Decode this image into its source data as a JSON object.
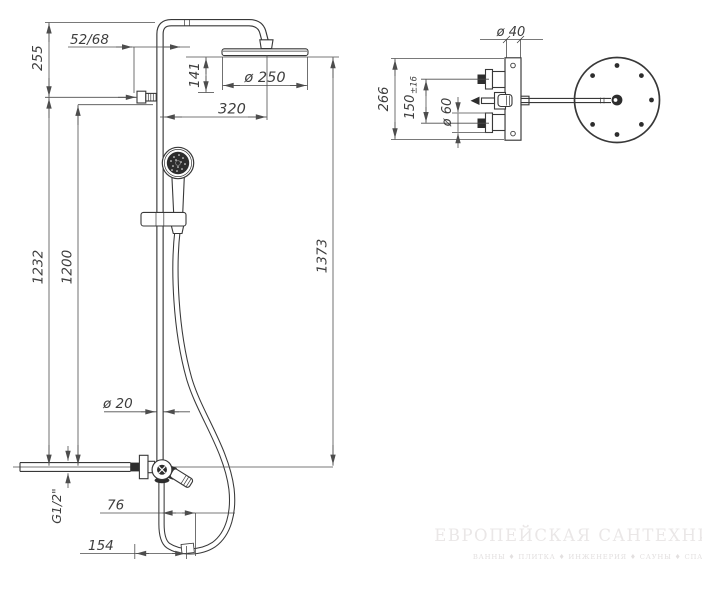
{
  "front_view": {
    "dims": {
      "top_offset": "255",
      "bracket_offset": "52/68",
      "head_drop": "141",
      "head_diameter": "ø 250",
      "arm_reach": "320",
      "rail_height": "1232",
      "slide_height": "1200",
      "total_height": "1373",
      "pipe_diameter": "ø 20",
      "inlet_thread": "G1/2\"",
      "hose_offset": "76",
      "base_width": "154"
    }
  },
  "top_view": {
    "dims": {
      "column_diameter": "ø 40",
      "plate_height": "266",
      "inlet_spacing": "150",
      "inlet_tolerance": "±16",
      "escutcheon_diameter": "ø 60"
    }
  },
  "watermark": {
    "title": "ЕВРОПЕЙСКАЯ САНТЕХНИКА",
    "subtitle": "ВАННЫ ♦ ПЛИТКА ♦ ИНЖЕНЕРИЯ ♦ САУНЫ ♦ СПА"
  },
  "colors": {
    "line": "#383838",
    "dimension": "#4d4d4d",
    "background": "#ffffff",
    "watermark": "#eae7e7"
  }
}
